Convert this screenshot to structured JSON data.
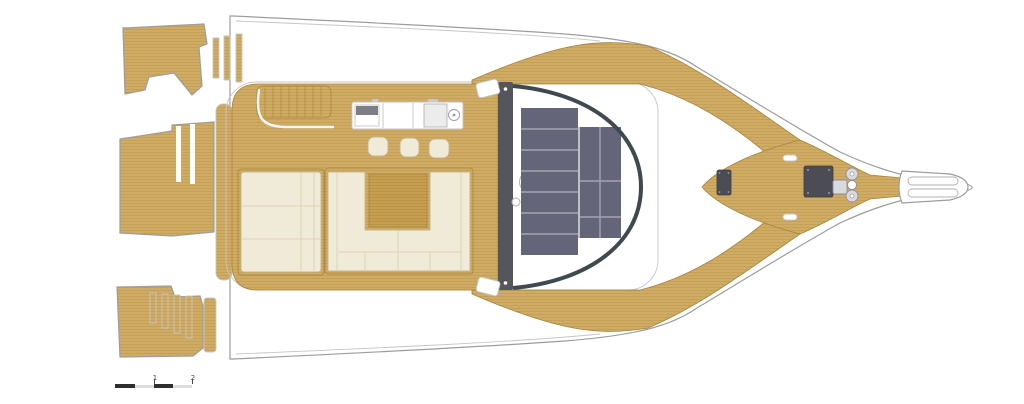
{
  "palette": {
    "teak": "#cfab63",
    "teak_line": "#b8924a",
    "teak_dark": "#c59e52",
    "teak_edge": "#a8853c",
    "hull_white": "#ffffff",
    "outline": "#9d9d9d",
    "outline_light": "#c6c6c6",
    "cushion": "#f0ebd9",
    "cushion_seam": "#ddd3b4",
    "cushion_edge": "#c4b68c",
    "panel": "#65657a",
    "panel_gap": "#a4a4b0",
    "frame_dark": "#55555e",
    "windshield": "#3e4a50",
    "hatch": "#4c4c55",
    "metal": "#d9d9de",
    "scale_dark": "#2f2f2f",
    "scale_light": "#dcdcdc",
    "label": "#4a4a4a"
  },
  "scale_bar": {
    "labels": [
      "1",
      "2"
    ]
  }
}
